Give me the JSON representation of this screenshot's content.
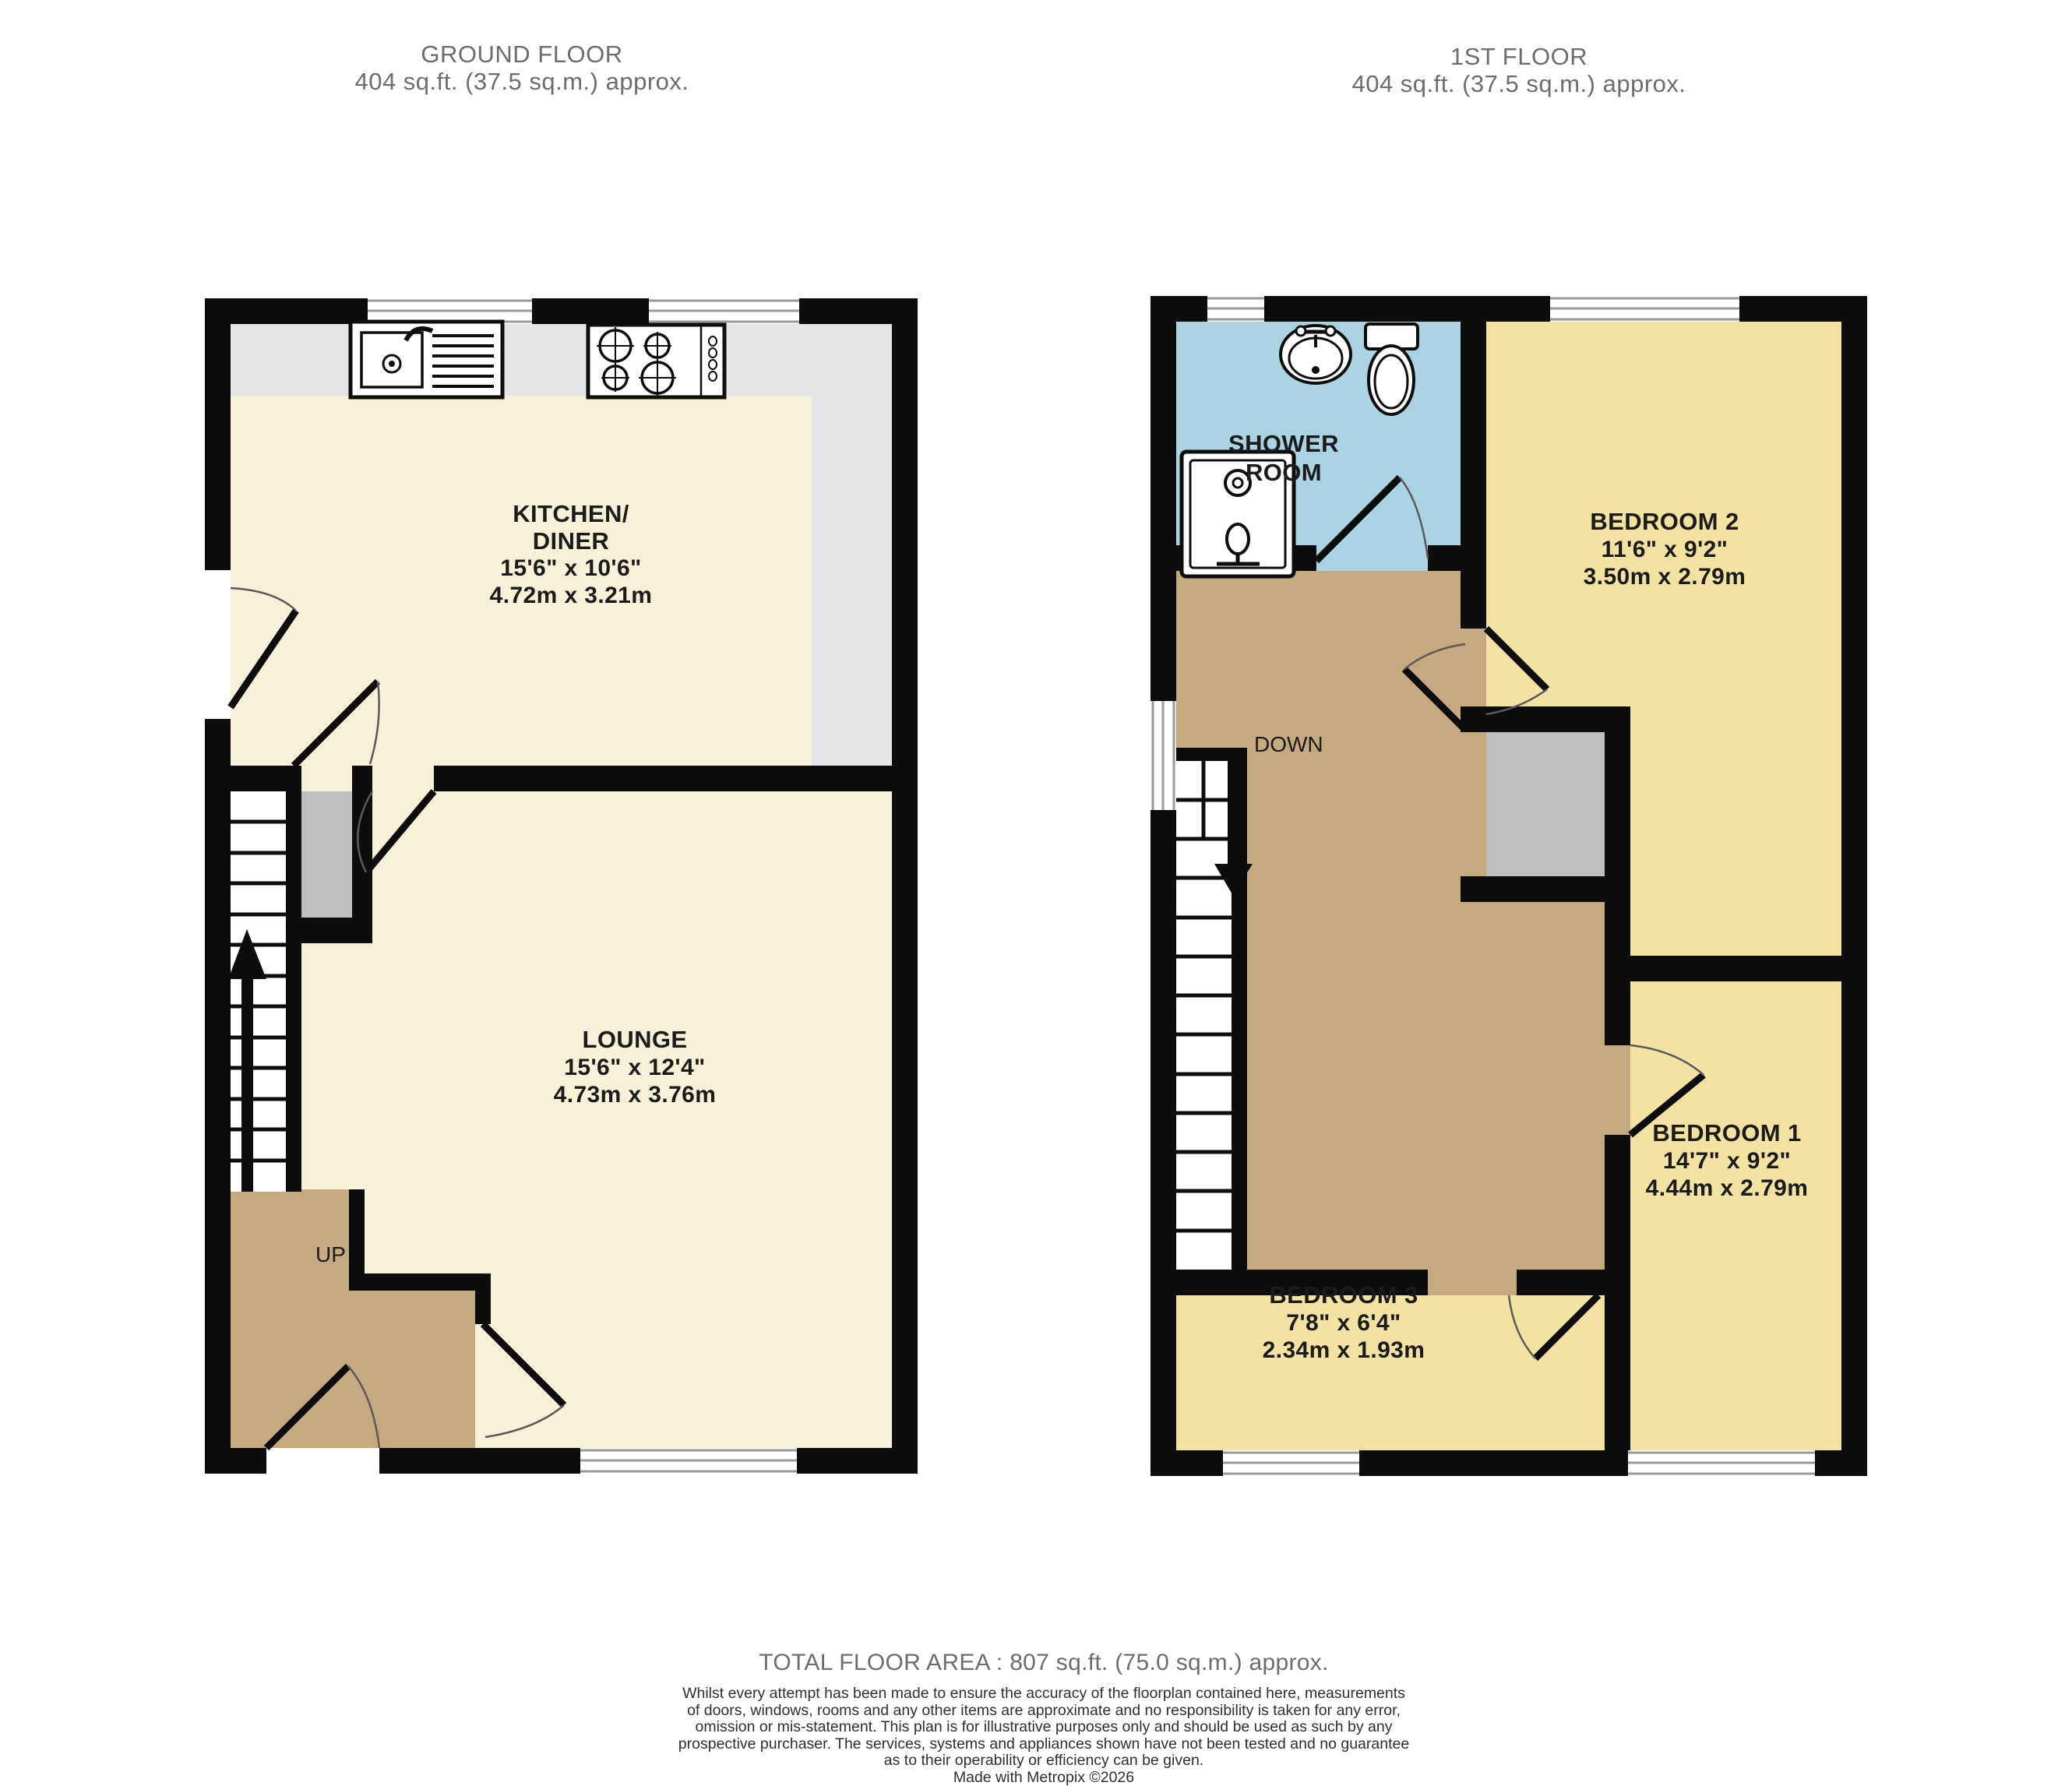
{
  "ground_floor": {
    "title": "GROUND FLOOR",
    "subtitle": "404 sq.ft. (37.5 sq.m.) approx.",
    "stairs_label": "UP",
    "rooms": {
      "kitchen": {
        "name_line1": "KITCHEN/",
        "name_line2": "DINER",
        "dims_imperial": "15'6\"  x 10'6\"",
        "dims_metric": "4.72m  x 3.21m"
      },
      "lounge": {
        "name": "LOUNGE",
        "dims_imperial": "15'6\"  x 12'4\"",
        "dims_metric": "4.73m  x 3.76m"
      }
    }
  },
  "first_floor": {
    "title": "1ST FLOOR",
    "subtitle": "404 sq.ft. (37.5 sq.m.) approx.",
    "stairs_label": "DOWN",
    "rooms": {
      "shower_room": {
        "name_line1": "SHOWER",
        "name_line2": "ROOM"
      },
      "bedroom2": {
        "name": "BEDROOM 2",
        "dims_imperial": "11'6\"  x 9'2\"",
        "dims_metric": "3.50m  x 2.79m"
      },
      "bedroom1": {
        "name": "BEDROOM 1",
        "dims_imperial": "14'7\"  x 9'2\"",
        "dims_metric": "4.44m  x 2.79m"
      },
      "bedroom3": {
        "name": "BEDROOM 3",
        "dims_imperial": "7'8\"  x 6'4\"",
        "dims_metric": "2.34m  x 1.93m"
      }
    }
  },
  "footer": {
    "total_area": "TOTAL FLOOR AREA : 807 sq.ft. (75.0 sq.m.) approx.",
    "disclaimer_lines": [
      "Whilst every attempt has been made to ensure the accuracy of the floorplan contained here, measurements",
      "of doors, windows, rooms and any other items are approximate and no responsibility is taken for any error,",
      "omission or mis-statement. This plan is for illustrative purposes only and should be used as such by any",
      "prospective purchaser. The services, systems and appliances shown have not been tested and no guarantee",
      "as to their operability or efficiency can be given."
    ],
    "credit": "Made with Metropix ©2026"
  },
  "colors": {
    "wall": "#0d0d0d",
    "ground_floor_room": "#f8f1d9",
    "bedroom": "#f2e3a3",
    "hall_landing": "#c5aa80",
    "shower_room": "#abd4e2",
    "kitchen_counter": "#e4e5e7",
    "cupboard": "#bfbfc1",
    "window_frame": "#9a9a9a"
  }
}
